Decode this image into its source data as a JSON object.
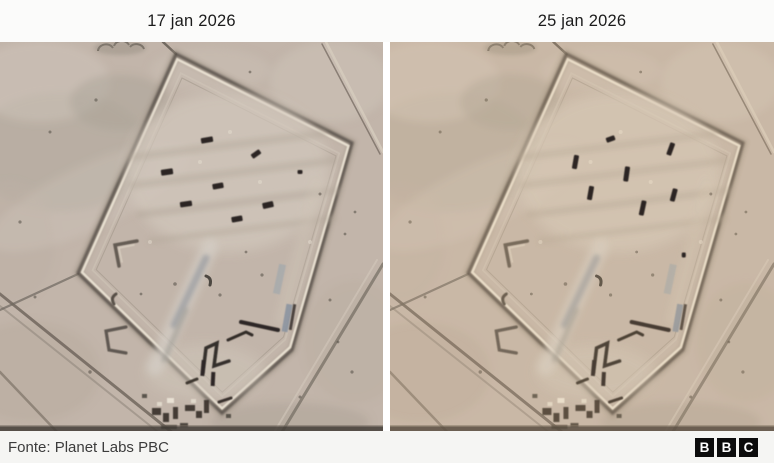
{
  "panels": [
    {
      "label": "17 jan 2026",
      "shadow_direction": "west",
      "marks": [
        {
          "x": 207,
          "y": 98,
          "w": 12,
          "h": 5.5,
          "r": -10
        },
        {
          "x": 256,
          "y": 112,
          "w": 10,
          "h": 5,
          "r": -35
        },
        {
          "x": 167,
          "y": 130,
          "w": 12,
          "h": 6,
          "r": -8
        },
        {
          "x": 218,
          "y": 144,
          "w": 11,
          "h": 5.5,
          "r": -10
        },
        {
          "x": 186,
          "y": 162,
          "w": 12,
          "h": 5.5,
          "r": -8
        },
        {
          "x": 268,
          "y": 163,
          "w": 11,
          "h": 6,
          "r": -12
        },
        {
          "x": 237,
          "y": 177,
          "w": 11,
          "h": 5.5,
          "r": -10
        },
        {
          "x": 300,
          "y": 130,
          "w": 5,
          "h": 4,
          "r": 0
        }
      ]
    },
    {
      "label": "25 jan 2026",
      "shadow_direction": "south",
      "marks": [
        {
          "x": 220,
          "y": 97,
          "w": 9,
          "h": 5,
          "r": -20
        },
        {
          "x": 280,
          "y": 107,
          "w": 5,
          "h": 13,
          "r": 20
        },
        {
          "x": 185,
          "y": 120,
          "w": 5,
          "h": 14,
          "r": 10
        },
        {
          "x": 236,
          "y": 132,
          "w": 5,
          "h": 15,
          "r": 8
        },
        {
          "x": 200,
          "y": 151,
          "w": 5,
          "h": 14,
          "r": 10
        },
        {
          "x": 283,
          "y": 153,
          "w": 5,
          "h": 13,
          "r": 15
        },
        {
          "x": 252,
          "y": 166,
          "w": 5,
          "h": 15,
          "r": 12
        },
        {
          "x": 293,
          "y": 213,
          "w": 4,
          "h": 5,
          "r": 0
        }
      ]
    }
  ],
  "footer": {
    "source": "Fonte: Planet Labs PBC",
    "logo_letters": [
      "B",
      "B",
      "C"
    ]
  },
  "colors": {
    "sand": "#c4b7ab",
    "berm_light": "#efe7d7",
    "berm_shadow": "#4b453d",
    "aircraft": "#1e1a16",
    "tint_left": "#b4a6a4",
    "tint_right": "#d2a76f",
    "highlight": "#ffffff",
    "header_bg": "#fbfbfa",
    "footer_bg": "#f5f5f3",
    "divider": "#ffffff",
    "label_text": "#1b1b1b",
    "source_text": "#3c3c3c",
    "bbc_black": "#0c0c0c"
  }
}
